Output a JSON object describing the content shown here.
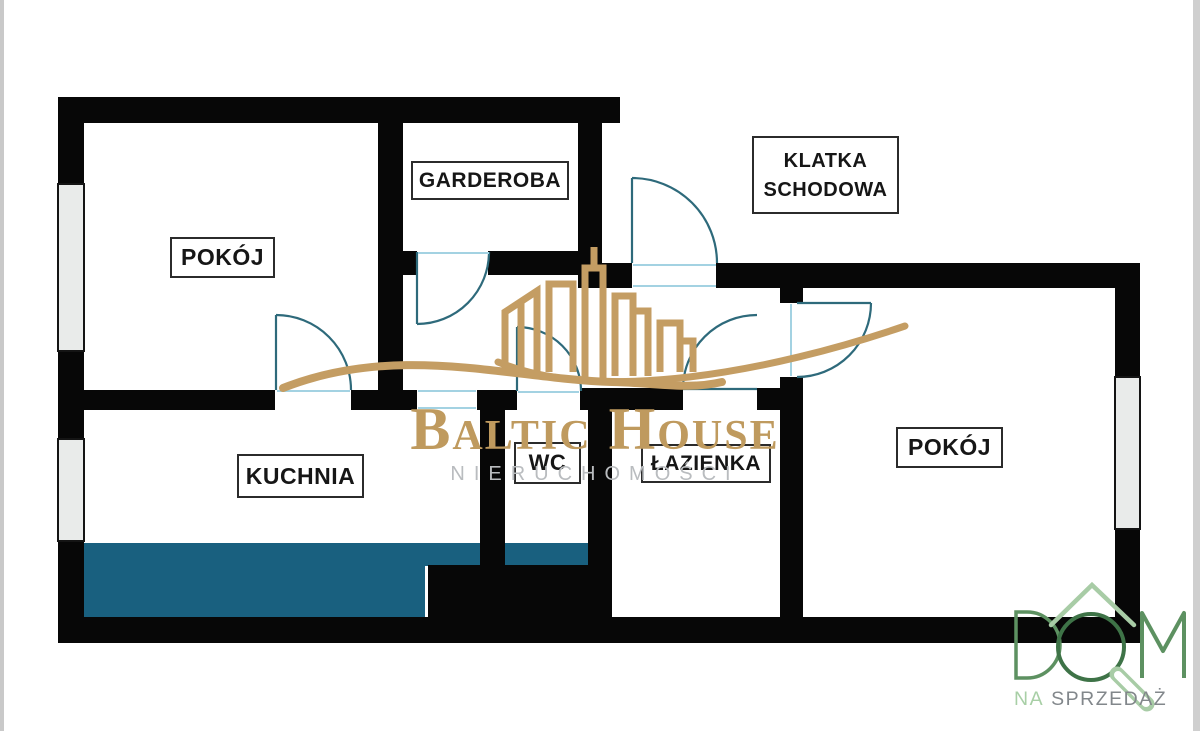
{
  "page": {
    "type": "apartment floor plan",
    "background": "#ffffff"
  },
  "rooms": {
    "pokoj_left": "POKÓJ",
    "garderoba": "GARDEROBA",
    "klatka_schodowa_line1": "KLATKA",
    "klatka_schodowa_line2": "SCHODOWA",
    "kuchnia": "KUCHNIA",
    "wc": "WC",
    "lazienka": "ŁAZIENKA",
    "pokoj_right": "POKÓJ"
  },
  "watermark": {
    "brand": "Baltic House",
    "subtitle": "NIERUCHOMOŚCI",
    "brand_color": "#bf9a5e",
    "subtitle_color": "#b9bcbf",
    "logo_gold": "#c49d63"
  },
  "agency_badge": {
    "word": "DOM",
    "caption_prefix": "NA",
    "caption_word": "SPRZEDAŻ",
    "green_dark": "#3e7347",
    "green": "#5d9161",
    "green_light": "#a8cca6",
    "caption_prefix_color": "#a8cfa6",
    "caption_color": "#82878b"
  },
  "plan_colors": {
    "wall": "#070707",
    "window_fill": "#e9ebea",
    "kitchen_counter": "#19607f",
    "door_arc": "#2e6a7b",
    "door_threshold": "#a3d2e2"
  }
}
